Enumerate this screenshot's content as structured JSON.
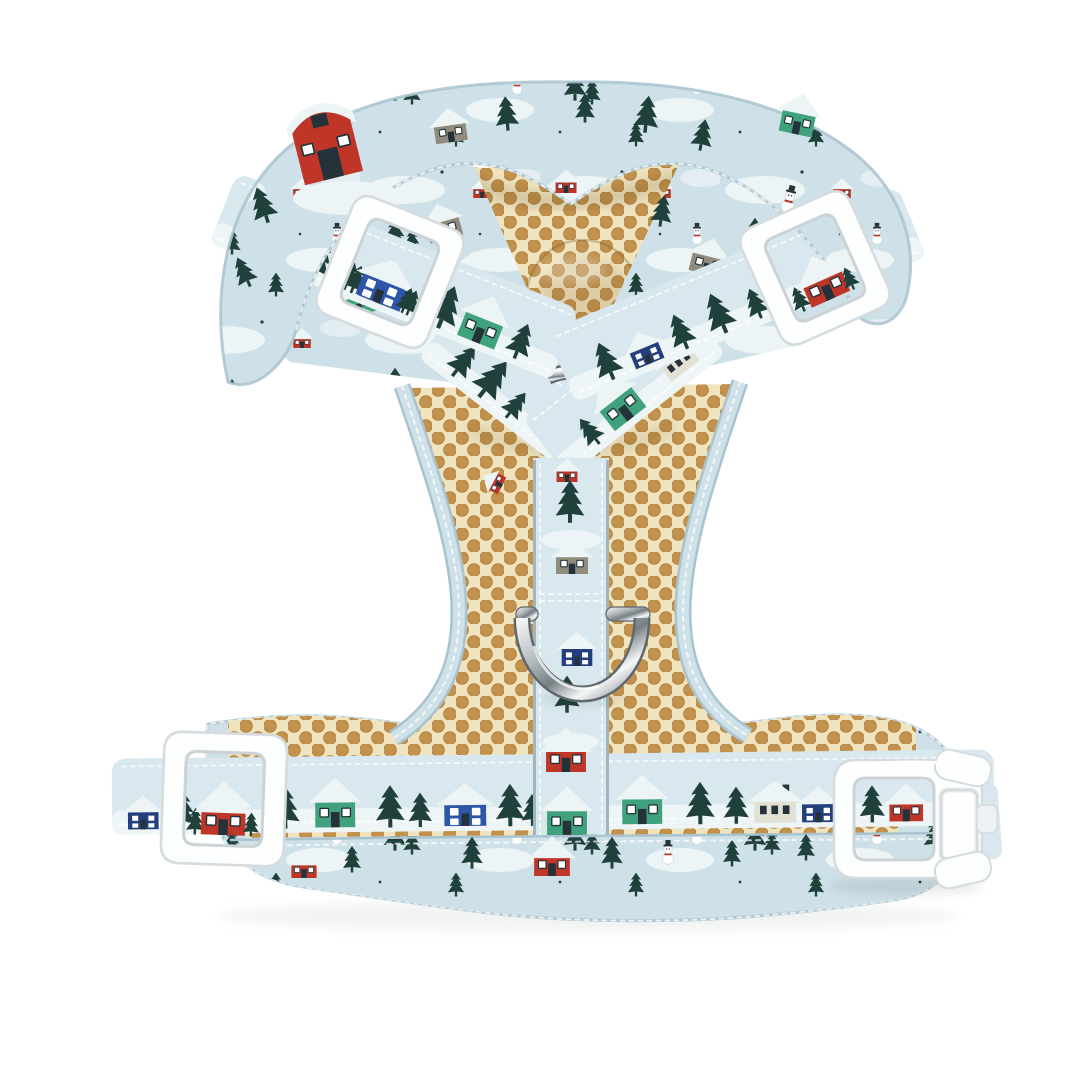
{
  "figure": {
    "alt": "Front view of a pale blue adjustable dog harness with a winter village print of houses, barns, pine trees and snowmen, tan honeycomb mesh lining, white plastic adjuster sliders and side-release buckle, and a silver metal leash D-ring, photographed on a plain white background",
    "background": "#ffffff"
  },
  "product": {
    "type": "adjustable dog harness",
    "view": "front, laid flat",
    "print_theme": "winter village",
    "lining": "tan honeycomb air mesh",
    "hardware_finish": "white plastic with silver metal rings",
    "motifs": [
      "red barn",
      "red cottage",
      "royal blue house",
      "navy house",
      "green cottage",
      "white house",
      "grey house",
      "pine tree",
      "snowman",
      "snow drifts"
    ],
    "components": {
      "collar": {
        "label": "padded neck collar panel"
      },
      "left_shoulder_strap": {
        "label": "left shoulder strap with white adjuster slider"
      },
      "right_shoulder_strap": {
        "label": "right shoulder strap with white adjuster slider"
      },
      "neck_mesh": {
        "label": "mesh neck inset with padded bump"
      },
      "chest_panel": {
        "label": "mesh chest panel with bound armhole edges"
      },
      "junction_ring": {
        "label": "silver metal junction ring"
      },
      "chest_strap": {
        "label": "vertical chest webbing strap"
      },
      "d_ring": {
        "label": "silver metal leash D-ring"
      },
      "belly_band": {
        "label": "padded belly band with mesh trim"
      },
      "girth_strap": {
        "label": "girth webbing strap"
      },
      "belly_slider": {
        "label": "white tri-glide adjuster slider"
      },
      "buckle": {
        "label": "white side-release buckle"
      }
    },
    "hardware_counts": {
      "sliders": 3,
      "buckles": 1,
      "d_rings": 1,
      "junction_rings": 1
    }
  },
  "palette": {
    "pageBg": "#ffffff",
    "fabric": "#cfe1e8",
    "fabricLight": "#e4eef2",
    "fabricEdge": "#a9c3cf",
    "snow": "#edf4f6",
    "web": "#d8e8ee",
    "webSnow": "#eef5f7",
    "tree": "#20403b",
    "red": "#bf3629",
    "blue": "#2d55a8",
    "navy": "#23407d",
    "green": "#3fa27d",
    "grayH": "#8f8b7d",
    "whiteBody": "#e3e0d5",
    "winDark": "#26323a",
    "meshBase": "#f0e4bf",
    "meshHole": "#c2914c",
    "meshShade": "#a87d3e",
    "plastic": "#fdfefe",
    "plasticEdge": "#d5dbde",
    "stitch": "#ffffff",
    "metalHi": "#f5f7f8",
    "metalMid": "#aeb6ba",
    "metalDark": "#777f84",
    "metalEdge": "#5f686d"
  }
}
